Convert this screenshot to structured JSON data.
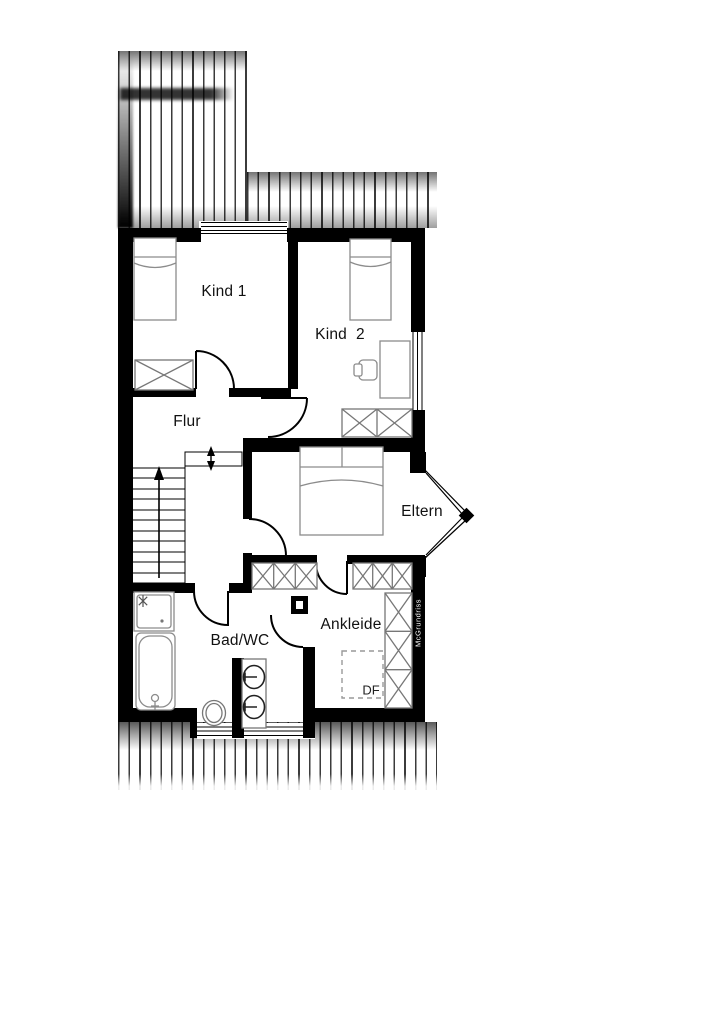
{
  "plan": {
    "rooms": [
      {
        "id": "kind1",
        "label": "Kind 1"
      },
      {
        "id": "kind2",
        "label": "Kind  2"
      },
      {
        "id": "flur",
        "label": "Flur"
      },
      {
        "id": "eltern",
        "label": "Eltern"
      },
      {
        "id": "bad_wc",
        "label": "Bad/WC"
      },
      {
        "id": "ankleide",
        "label": "Ankleide"
      }
    ],
    "annotations": {
      "roof_window_label": "DF",
      "watermark": "McGrundriss"
    },
    "colors": {
      "walls": "#000000",
      "furniture_outline": "#8c8c8c",
      "roof_hatch": "#2e2e2e",
      "background": "#ffffff"
    }
  }
}
